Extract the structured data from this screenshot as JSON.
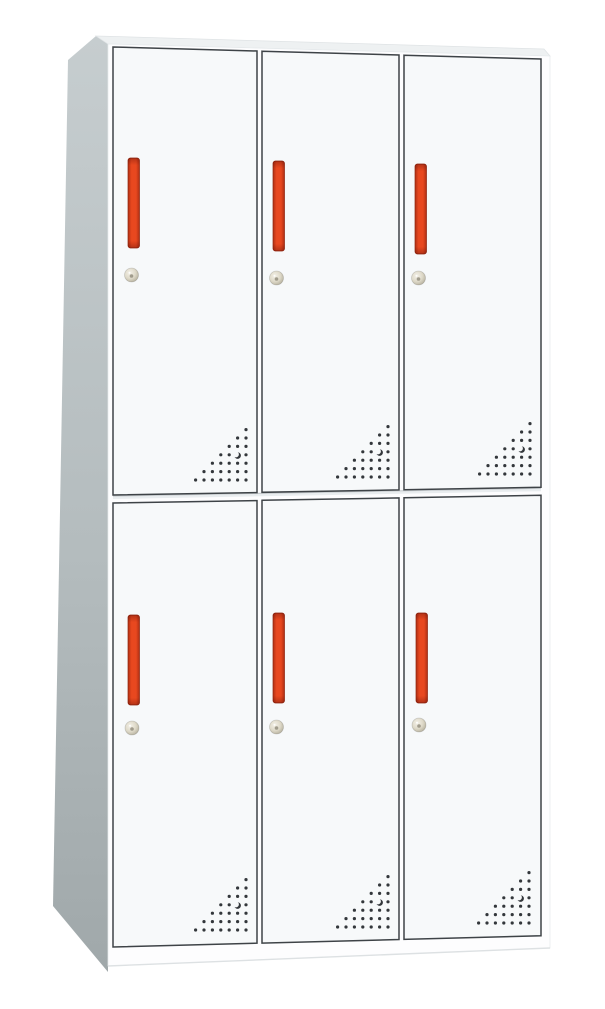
{
  "image": {
    "background_color": "#ffffff",
    "subject": "six-door-metal-locker-cabinet",
    "view": "front-left-perspective"
  },
  "locker": {
    "rows": 2,
    "columns": 3,
    "door_count": 6,
    "doors": [
      {
        "id": "door-1",
        "row": 1,
        "col": 1
      },
      {
        "id": "door-2",
        "row": 1,
        "col": 2
      },
      {
        "id": "door-3",
        "row": 1,
        "col": 3
      },
      {
        "id": "door-4",
        "row": 2,
        "col": 1
      },
      {
        "id": "door-5",
        "row": 2,
        "col": 2
      },
      {
        "id": "door-6",
        "row": 2,
        "col": 3
      }
    ],
    "parts_per_door": [
      "door-handle",
      "door-lock",
      "vent-holes"
    ],
    "vent": {
      "pattern": "right-triangle-dot-matrix",
      "rows": 7,
      "has_crescent_cutout": true
    },
    "colors": {
      "door_face": "#f7f9fa",
      "door_border": "#3e4347",
      "front_frame": "#fdfdfe",
      "side_panel_top": "#c6cdcf",
      "side_panel_mid": "#b4bcbe",
      "side_panel_bottom": "#a0a8aa",
      "top_panel": "#eef1f2",
      "handle_main": "#e8481f",
      "handle_dark": "#b02f13",
      "handle_outline": "#8f240e",
      "lock_face": "#ddd8c7",
      "lock_edge": "#b0ab98",
      "lock_keyhole": "#8a8474",
      "vent_dot": "#33373b",
      "row_gap_shadow": "#c9ced1",
      "row_gap_fill": "#e9edef",
      "edge_line": "#dde1e3"
    }
  }
}
